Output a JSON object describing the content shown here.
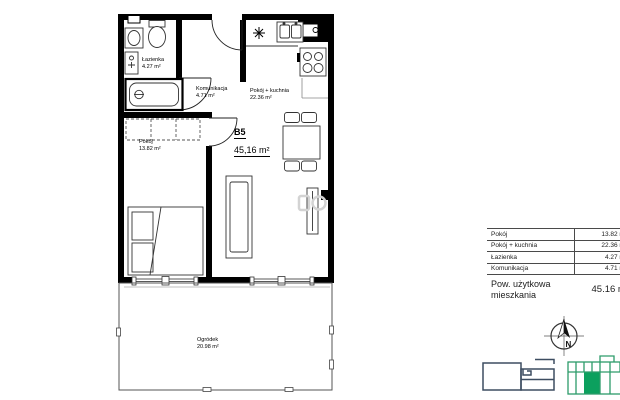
{
  "plan": {
    "unit": {
      "label": "B5",
      "area": "45,16 m²"
    },
    "rooms": [
      {
        "name": "Łazienka",
        "area": "4.27 m²"
      },
      {
        "name": "Komunikacja",
        "area": "4.71 m²"
      },
      {
        "name": "Pokój + kuchnia",
        "area": "22.36 m²"
      },
      {
        "name": "Pokój",
        "area": "13.82 m²"
      },
      {
        "name": "Ogródek",
        "area": "20.98 m²"
      }
    ]
  },
  "area_table": {
    "rows": [
      {
        "label": "Pokój",
        "value": "13.82 m²"
      },
      {
        "label": "Pokój + kuchnia",
        "value": "22.36 m²"
      },
      {
        "label": "Łazienka",
        "value": "4.27 m²"
      },
      {
        "label": "Komunikacja",
        "value": "4.71 m²"
      }
    ],
    "total_label": "Pow. użytkowa mieszkania",
    "total_value": "45.16 m²"
  },
  "compass": {
    "north_label": "N"
  },
  "colors": {
    "wall": "#000000",
    "line": "#333333",
    "navy_outline": "#3d4d61",
    "green_outline": "#2d9c6a",
    "green_fill": "#0ca05e"
  }
}
